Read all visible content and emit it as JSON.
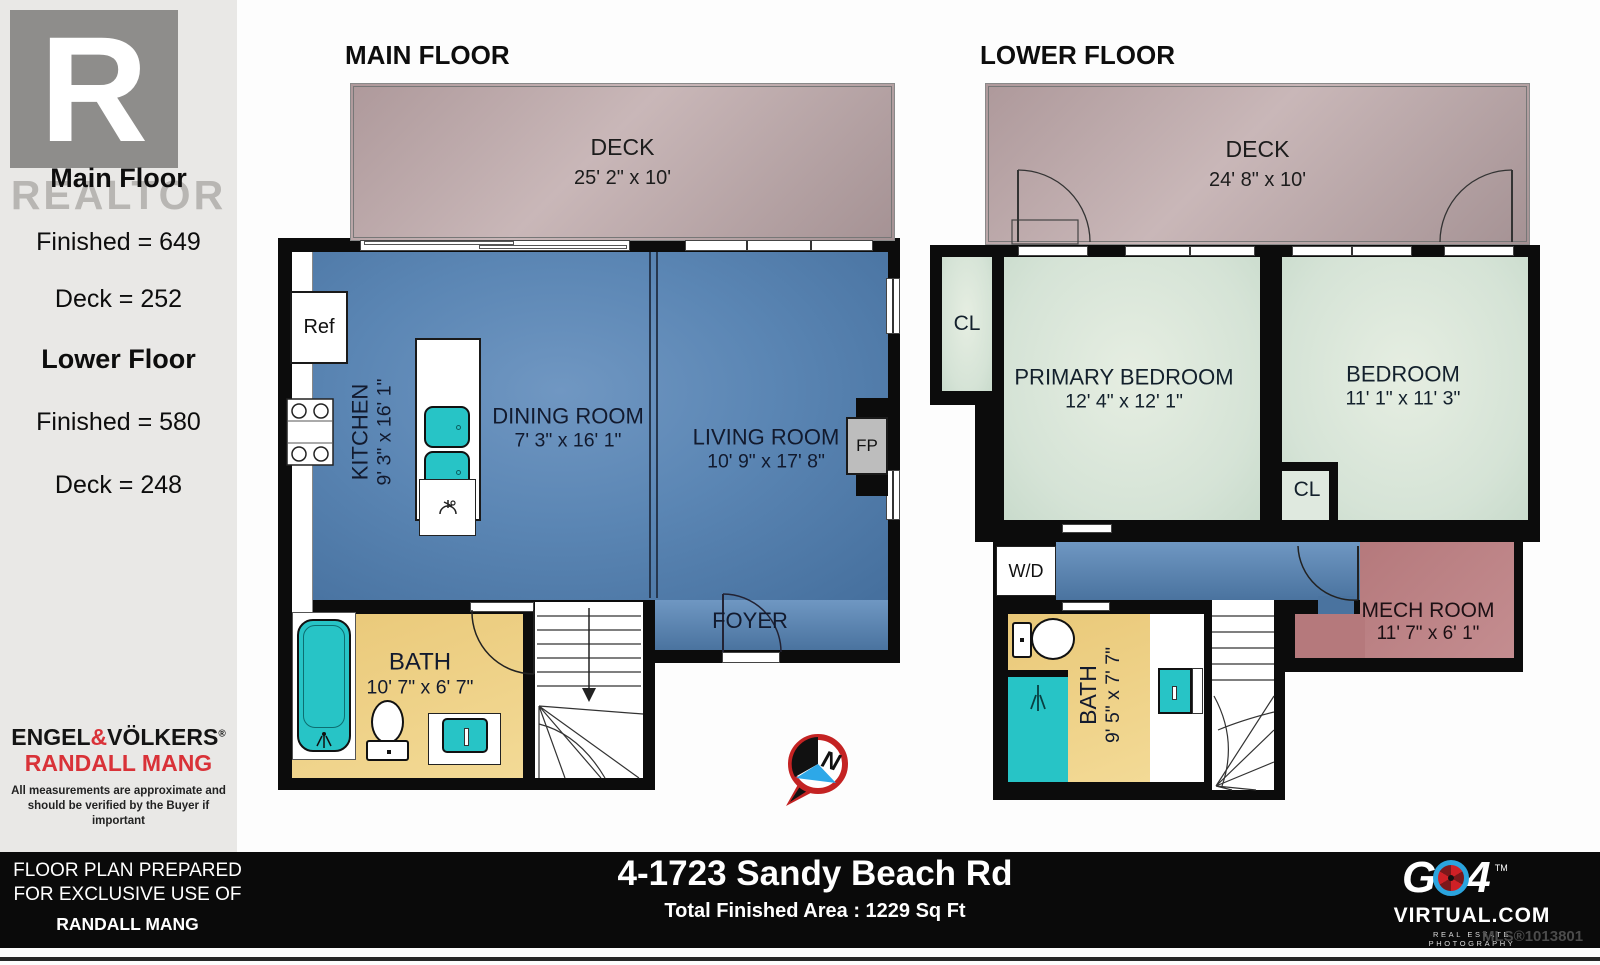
{
  "sidebar": {
    "logo_letter": "R",
    "watermark": "REALTOR",
    "main_floor_summary": {
      "title": "Main Floor",
      "finished": "Finished = 649",
      "deck": "Deck = 252"
    },
    "lower_floor_summary": {
      "title": "Lower Floor",
      "finished": "Finished = 580",
      "deck": "Deck = 248"
    },
    "brokerage": {
      "part1": "ENGEL",
      "amp": "&",
      "part2": "VÖLKERS",
      "reg": "®",
      "agent": "RANDALL MANG"
    },
    "disclaimer_line1": "All measurements are approximate and",
    "disclaimer_line2": "should be verified by the Buyer if important"
  },
  "footer": {
    "prepared_line1": "FLOOR PLAN PREPARED",
    "prepared_line2": "FOR EXCLUSIVE USE OF",
    "prepared_name": "RANDALL MANG",
    "address": "4-1723 Sandy Beach Rd",
    "total_area": "Total Finished Area : 1229 Sq Ft",
    "mls": "MLS®1013801",
    "logo": {
      "g": "G",
      "four": "4",
      "tm": "TM",
      "domain": "VIRTUAL.COM",
      "tagline": "REAL ESTATE PHOTOGRAPHY"
    }
  },
  "main_floor": {
    "title": "MAIN FLOOR",
    "deck": {
      "name": "DECK",
      "dims": "25' 2\" x 10'"
    },
    "kitchen": {
      "name": "KITCHEN",
      "dims": "9' 3\" x 16' 1\""
    },
    "dining": {
      "name": "DINING ROOM",
      "dims": "7' 3\" x 16' 1\""
    },
    "living": {
      "name": "LIVING ROOM",
      "dims": "10' 9\" x 17' 8\""
    },
    "bath": {
      "name": "BATH",
      "dims": "10' 7\" x 6' 7\""
    },
    "foyer": {
      "name": "FOYER"
    },
    "ref_label": "Ref",
    "fp_label": "FP",
    "compass_n": "N"
  },
  "lower_floor": {
    "title": "LOWER FLOOR",
    "deck": {
      "name": "DECK",
      "dims": "24' 8\" x 10'"
    },
    "primary": {
      "name": "PRIMARY BEDROOM",
      "dims": "12' 4\" x 12' 1\""
    },
    "bedroom": {
      "name": "BEDROOM",
      "dims": "11' 1\" x 11' 3\""
    },
    "bath": {
      "name": "BATH",
      "dims": "9' 5\" x 7' 7\""
    },
    "mech": {
      "name": "MECH ROOM",
      "dims": "11' 7\" x 6' 1\""
    },
    "closet1_label": "CL",
    "closet2_label": "CL",
    "wd_label": "W/D"
  },
  "colors": {
    "main_floor_fill": "#5b86b4",
    "deck_fill": "#b9a6a8",
    "bath_fill": "#ecca7c",
    "bedroom_fill": "#dce8dc",
    "mech_fill": "#b5797c",
    "fixture_teal": "#27c4c6",
    "brand_red": "#d93238",
    "footer_bg": "#0a0a0a"
  }
}
